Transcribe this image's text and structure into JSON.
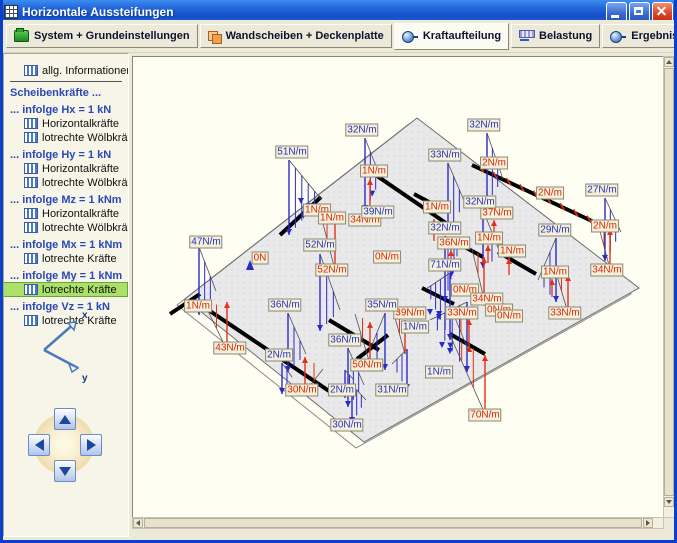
{
  "window": {
    "title": "Horizontale Aussteifungen"
  },
  "toolbar": {
    "tabs": [
      {
        "label": "System + Grundeinstellungen",
        "icon": "ic-system",
        "active": false
      },
      {
        "label": "Wandscheiben + Deckenplatte",
        "icon": "ic-walls",
        "active": false
      },
      {
        "label": "Kraftaufteilung",
        "icon": "ic-node",
        "active": true
      },
      {
        "label": "Belastung",
        "icon": "ic-load",
        "active": false
      },
      {
        "label": "Ergebnisse",
        "icon": "ic-node",
        "active": false
      }
    ],
    "actions": [
      {
        "name": "save-button",
        "icon": "ic-save"
      },
      {
        "name": "print-button",
        "icon": "ic-print"
      },
      {
        "name": "help-button",
        "icon": "ic-help",
        "glyph": "?"
      },
      {
        "name": "confirm-button",
        "icon": "ic-check"
      }
    ]
  },
  "sidebar": {
    "items": [
      {
        "label": "allg. Informationen",
        "type": "info",
        "selected": false
      },
      {
        "type": "divider"
      },
      {
        "label": "Scheibenkräfte ...",
        "type": "header"
      },
      {
        "label": "...  infolge Hx = 1 kN",
        "type": "header"
      },
      {
        "label": "Horizontalkräfte",
        "type": "info",
        "selected": false
      },
      {
        "label": "lotrechte Wölbkräfte",
        "type": "info",
        "selected": false
      },
      {
        "label": "... infolge Hy = 1 kN",
        "type": "header"
      },
      {
        "label": "Horizontalkräfte",
        "type": "info",
        "selected": false
      },
      {
        "label": "lotrechte Wölbkräfte",
        "type": "info",
        "selected": false
      },
      {
        "label": "... infolge Mz = 1 kNm",
        "type": "header"
      },
      {
        "label": "Horizontalkräfte",
        "type": "info",
        "selected": false
      },
      {
        "label": "lotrechte Wölbkräfte",
        "type": "info",
        "selected": false
      },
      {
        "label": "... infolge Mx = 1 kNm",
        "type": "header"
      },
      {
        "label": "lotrechte Kräfte",
        "type": "info",
        "selected": false
      },
      {
        "label": "... infolge My = 1 kNm",
        "type": "header"
      },
      {
        "label": "lotrechte Kräfte",
        "type": "info",
        "selected": true
      },
      {
        "label": "... infolge Vz = 1 kN",
        "type": "header"
      },
      {
        "label": "lotrechte Kräfte",
        "type": "info",
        "selected": false
      }
    ],
    "axes": {
      "x_label": "x",
      "y_label": "y"
    }
  },
  "diagram": {
    "description": "lotrechte Kräfte infolge My = 1 kNm, Deckenplatte mit Wandscheiben",
    "unit": "N/m",
    "colors": {
      "blue": "#2331c0",
      "red": "#d82808",
      "wall": "#000000",
      "plate": "#eaeaea"
    },
    "labels": [
      {
        "text": "1N/m",
        "color": "red",
        "x": 241,
        "y": 114
      },
      {
        "text": "2N/m",
        "color": "red",
        "x": 361,
        "y": 106
      },
      {
        "text": "2N/m",
        "color": "red",
        "x": 417,
        "y": 136
      },
      {
        "text": "1N/m",
        "color": "red",
        "x": 304,
        "y": 150
      },
      {
        "text": "37N/m",
        "color": "red",
        "x": 364,
        "y": 156
      },
      {
        "text": "1N/m",
        "color": "red",
        "x": 184,
        "y": 153
      },
      {
        "text": "1N/m",
        "color": "red",
        "x": 199,
        "y": 161
      },
      {
        "text": "34N/m",
        "color": "red",
        "x": 232,
        "y": 163
      },
      {
        "text": "2N/m",
        "color": "red",
        "x": 472,
        "y": 169
      },
      {
        "text": "36N/m",
        "color": "red",
        "x": 321,
        "y": 186
      },
      {
        "text": "1N/m",
        "color": "red",
        "x": 356,
        "y": 181
      },
      {
        "text": "1N/m",
        "color": "red",
        "x": 379,
        "y": 194
      },
      {
        "text": "0N",
        "color": "red",
        "x": 127,
        "y": 201
      },
      {
        "text": "0N/m",
        "color": "red",
        "x": 254,
        "y": 200
      },
      {
        "text": "52N/m",
        "color": "red",
        "x": 199,
        "y": 213
      },
      {
        "text": "1N/m",
        "color": "red",
        "x": 422,
        "y": 215
      },
      {
        "text": "34N/m",
        "color": "red",
        "x": 474,
        "y": 213
      },
      {
        "text": "0N/m",
        "color": "red",
        "x": 332,
        "y": 233
      },
      {
        "text": "34N/m",
        "color": "red",
        "x": 354,
        "y": 242
      },
      {
        "text": "1N/m",
        "color": "red",
        "x": 65,
        "y": 249
      },
      {
        "text": "0N/m",
        "color": "red",
        "x": 366,
        "y": 253
      },
      {
        "text": "0N/m",
        "color": "red",
        "x": 376,
        "y": 259
      },
      {
        "text": "33N/m",
        "color": "red",
        "x": 329,
        "y": 256
      },
      {
        "text": "33N/m",
        "color": "red",
        "x": 432,
        "y": 256
      },
      {
        "text": "39N/m",
        "color": "red",
        "x": 277,
        "y": 256
      },
      {
        "text": "43N/m",
        "color": "red",
        "x": 97,
        "y": 291
      },
      {
        "text": "50N/m",
        "color": "red",
        "x": 234,
        "y": 308
      },
      {
        "text": "30N/m",
        "color": "red",
        "x": 169,
        "y": 333
      },
      {
        "text": "70N/m",
        "color": "red",
        "x": 352,
        "y": 358
      },
      {
        "text": "32N/m",
        "color": "blue",
        "x": 229,
        "y": 73
      },
      {
        "text": "32N/m",
        "color": "blue",
        "x": 351,
        "y": 68
      },
      {
        "text": "51N/m",
        "color": "blue",
        "x": 159,
        "y": 95
      },
      {
        "text": "33N/m",
        "color": "blue",
        "x": 312,
        "y": 98
      },
      {
        "text": "27N/m",
        "color": "blue",
        "x": 469,
        "y": 133
      },
      {
        "text": "32N/m",
        "color": "blue",
        "x": 347,
        "y": 145
      },
      {
        "text": "39N/m",
        "color": "blue",
        "x": 245,
        "y": 155
      },
      {
        "text": "32N/m",
        "color": "blue",
        "x": 312,
        "y": 171
      },
      {
        "text": "29N/m",
        "color": "blue",
        "x": 422,
        "y": 173
      },
      {
        "text": "47N/m",
        "color": "blue",
        "x": 73,
        "y": 185
      },
      {
        "text": "52N/m",
        "color": "blue",
        "x": 187,
        "y": 188
      },
      {
        "text": "71N/m",
        "color": "blue",
        "x": 312,
        "y": 208
      },
      {
        "text": "36N/m",
        "color": "blue",
        "x": 152,
        "y": 248
      },
      {
        "text": "35N/m",
        "color": "blue",
        "x": 249,
        "y": 248
      },
      {
        "text": "1N/m",
        "color": "blue",
        "x": 282,
        "y": 270
      },
      {
        "text": "36N/m",
        "color": "blue",
        "x": 212,
        "y": 283
      },
      {
        "text": "2N/m",
        "color": "blue",
        "x": 146,
        "y": 298
      },
      {
        "text": "1N/m",
        "color": "blue",
        "x": 306,
        "y": 315
      },
      {
        "text": "31N/m",
        "color": "blue",
        "x": 259,
        "y": 333
      },
      {
        "text": "2N/m",
        "color": "blue",
        "x": 209,
        "y": 333
      },
      {
        "text": "30N/m",
        "color": "blue",
        "x": 214,
        "y": 368
      }
    ]
  }
}
